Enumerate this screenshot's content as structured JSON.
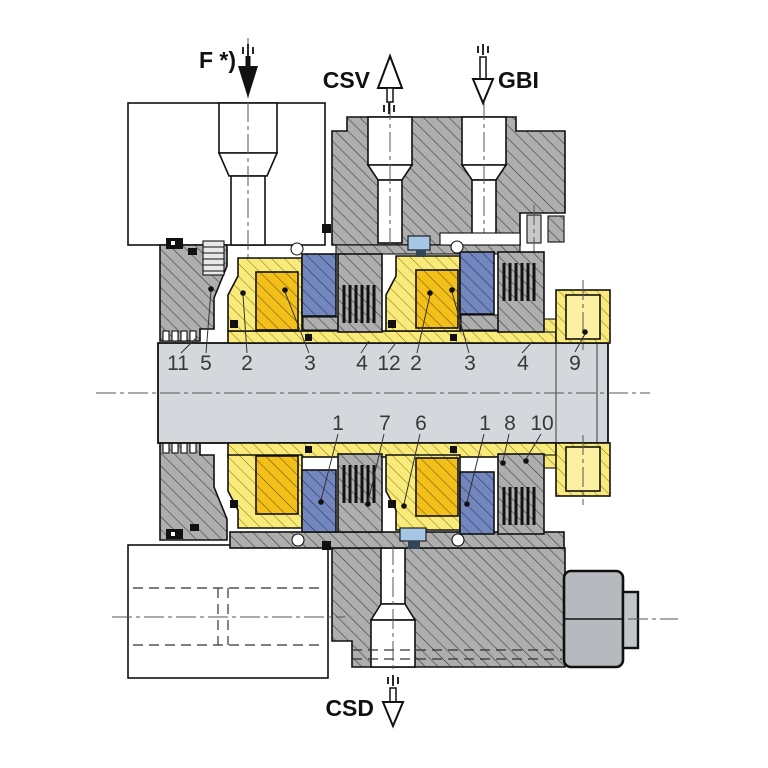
{
  "labels": {
    "force": "F *)",
    "csv": "CSV",
    "gbi": "GBI",
    "csd": "CSD"
  },
  "part_numbers_top": [
    "11",
    "5",
    "2",
    "3",
    "4",
    "12",
    "2",
    "3",
    "4",
    "9"
  ],
  "part_numbers_bottom": [
    "1",
    "7",
    "6",
    "1",
    "8",
    "10"
  ],
  "colors": {
    "housing_gray": "#AEAEAE",
    "sleeve_yellow": "#F9EA7C",
    "face_gold": "#F3C01A",
    "ring_blue": "#7387BE",
    "shaft_gray": "#D4D7DB",
    "steel_gray": "#B6BABE",
    "detail_blue": "#A6C6E6",
    "line": "#111111"
  }
}
